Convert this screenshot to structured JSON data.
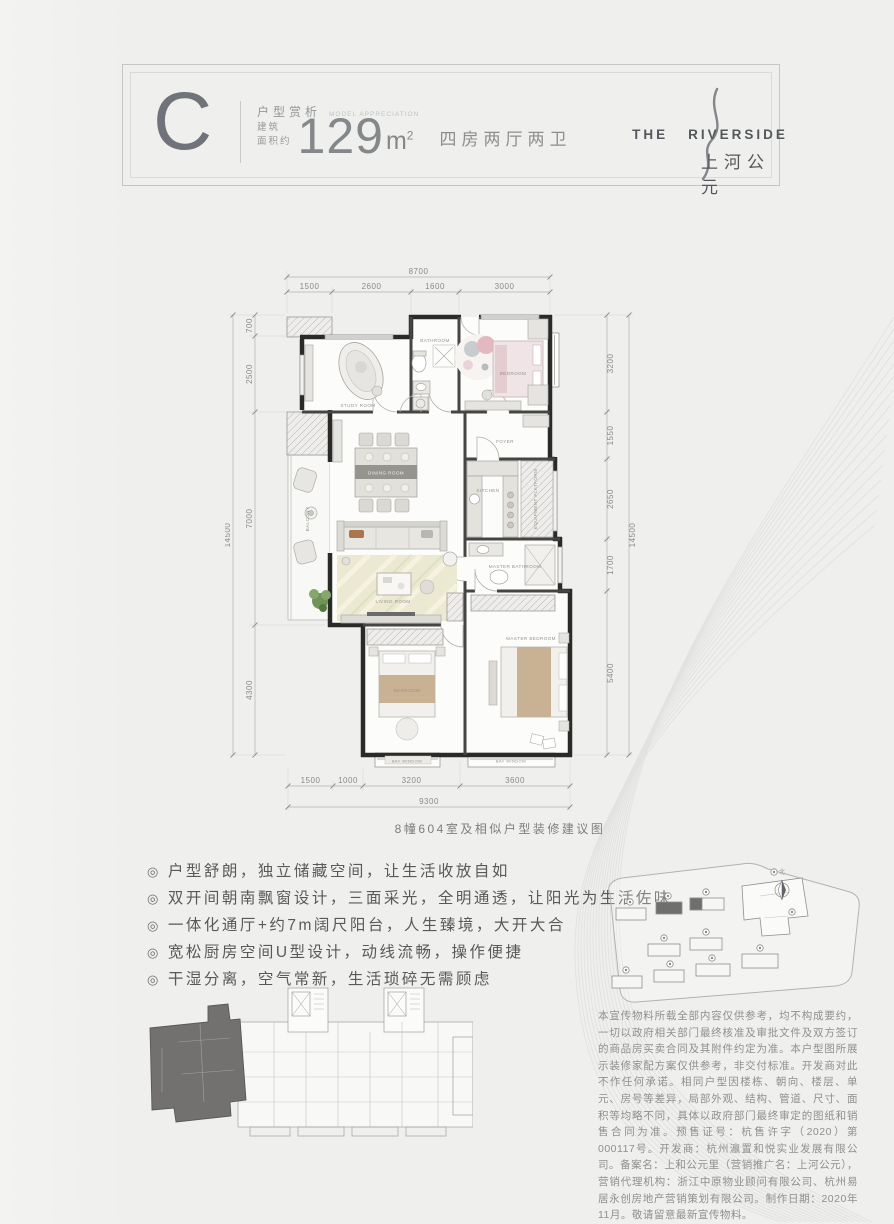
{
  "header": {
    "letter": "C",
    "label_cn": "户型赏析",
    "label_en": "MODEL APPRECIATION",
    "area_prefix1": "建筑",
    "area_prefix2": "面积约",
    "area_value": "129",
    "area_unit": "m",
    "area_sup": "2",
    "rooms_desc": "四房两厅两卫",
    "logo": {
      "the": "THE",
      "riverside": "RIVERSIDE",
      "cn": "上河公元"
    }
  },
  "floorplan": {
    "caption": "8幢604室及相似户型装修建议图",
    "dims_top_total": "8700",
    "dims_top": [
      "1500",
      "2600",
      "1600",
      "3000"
    ],
    "dims_bottom": [
      "1500",
      "1000",
      "3200",
      "3600"
    ],
    "dims_bottom_total": "9300",
    "dims_left": [
      "700",
      "2500",
      "7000",
      "4300"
    ],
    "dims_left_total": "14500",
    "dims_right": [
      "3200",
      "1550",
      "2650",
      "1700",
      "5400"
    ],
    "dims_right_total": "14500",
    "rooms": {
      "study": "STUDY ROOM",
      "bathroom": "BATHROOM",
      "kids": "BEDROOM",
      "foyer": "FOYER",
      "dining": "DINING ROOM",
      "kitchen": "KITCHEN",
      "equipment": "EQUIPMENT PLATFORM",
      "balcony": "BALCONY",
      "living": "LIVING ROOM",
      "master_bath": "MASTER BATHROOM",
      "bedroom": "BEDROOM",
      "master": "MASTER BEDROOM",
      "bay": "BAY WINDOW"
    }
  },
  "features": {
    "bullet": "◎",
    "items": [
      "户型舒朗，独立储藏空间，让生活收放自如",
      "双开间朝南飘窗设计，三面采光，全明通透，让阳光为生活佐味",
      "一体化通厅+约7m阔尺阳台，人生臻境，大开大合",
      "宽松厨房空间U型设计，动线流畅，操作便捷",
      "干湿分离，空气常新，生活琐碎无需顾虑"
    ]
  },
  "siteplan": {
    "north": "北"
  },
  "disclaimer": {
    "text": "本宣传物料所载全部内容仅供参考，均不构成要约，一切以政府相关部门最终核准及审批文件及双方签订的商品房买卖合同及其附件约定为准。本户型图所展示装修家配方案仅供参考，非交付标准。开发商对此不作任何承诺。相同户型因楼栋、朝向、楼层、单元、房号等差异，局部外观、结构、管道、尺寸、面积等均略不同，具体以政府部门最终审定的图纸和销售合同为准。预售证号：杭售许字（2020）第000117号。开发商：杭州瀛置和悦实业发展有限公司。备案名：上和公元里（营销推广名：上河公元），营销代理机构：浙江中原物业顾问有限公司、杭州易居永创房地产营销策划有限公司。制作日期：2020年11月。敬请留意最新宣传物料。"
  }
}
